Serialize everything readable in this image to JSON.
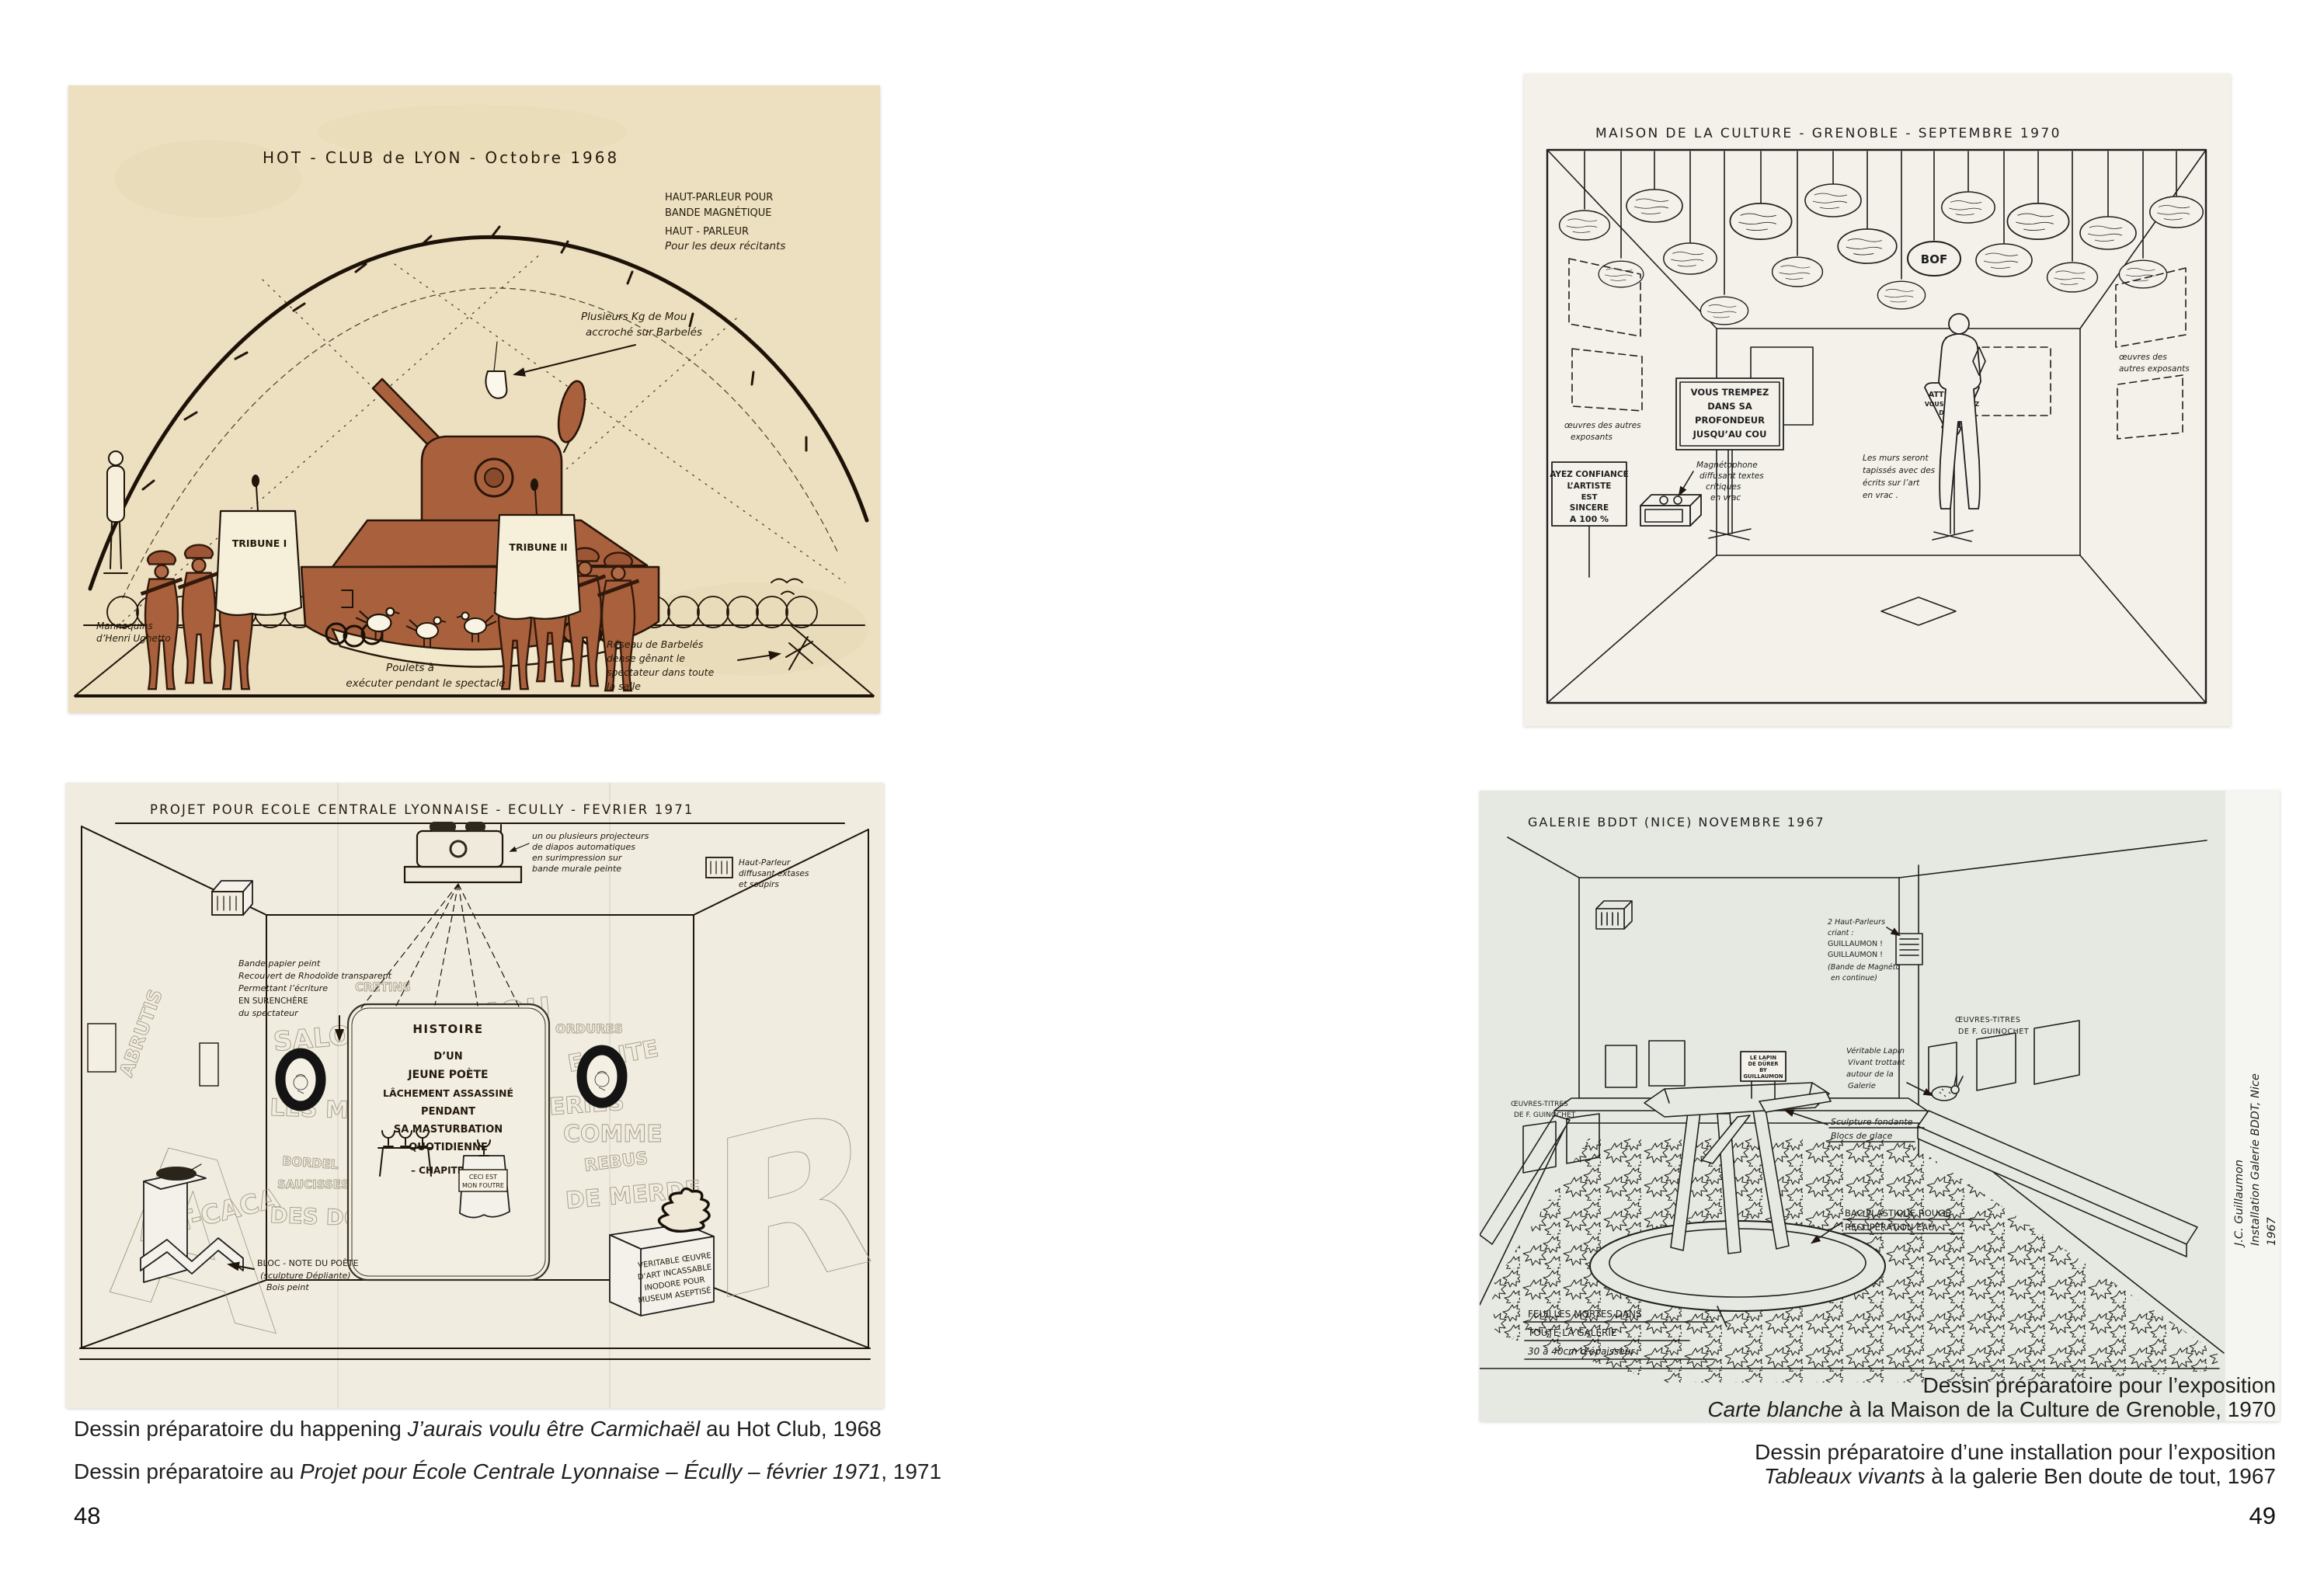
{
  "spread": {
    "left_page_number": "48",
    "right_page_number": "49"
  },
  "colors": {
    "page_bg": "#ffffff",
    "caption_text": "#1f1f1f",
    "paper_hotclub": "#ece0c0",
    "paper_ecole": "#f0ecdf",
    "paper_maison": "#f3f1e9",
    "paper_bddt": "#e6e8e2",
    "tank_brown": "#a8613c",
    "pencil_gray": "#a39a86",
    "ink": "#20150a"
  },
  "captions_left": [
    {
      "pre": "Dessin préparatoire du happening ",
      "italic": "J’aurais voulu être Carmichaël",
      "post": " au Hot Club, 1968"
    },
    {
      "pre": "Dessin préparatoire au ",
      "italic": "Projet pour École Centrale Lyonnaise – Écully – février 1971",
      "post": ", 1971"
    }
  ],
  "captions_right": [
    {
      "line1": "Dessin préparatoire pour l’exposition",
      "italic": "Carte blanche",
      "post": " à la Maison de la Culture de Grenoble, 1970"
    },
    {
      "line1": "Dessin préparatoire d’une installation pour l’exposition",
      "italic": "Tableaux vivants",
      "post": " à la galerie Ben doute de tout, 1967"
    }
  ],
  "hotclub": {
    "title": "HOT - CLUB  de  LYON  -  Octobre  1968",
    "speaker_note": [
      "HAUT-PARLEUR POUR",
      "BANDE MAGNÉTIQUE",
      "HAUT - PARLEUR",
      "Pour les deux récitants"
    ],
    "mou_note": [
      "Plusieurs Kg de Mou",
      "accroché sur Barbelés"
    ],
    "tribune1": "TRIBUNE I",
    "tribune2": "TRIBUNE II",
    "mannequins_note": [
      "Mannequins",
      "d’Henri Ughetto"
    ],
    "poulets_note": [
      "Poulets à",
      "exécuter pendant le spectacle"
    ],
    "reseau_note": [
      "Réseau de Barbelés",
      "dense gênant le",
      "spectateur dans toute",
      "la salle"
    ]
  },
  "ecole": {
    "title": "PROJET  POUR  ECOLE  CENTRALE  LYONNAISE - ECULLY -  FEVRIER  1971",
    "projector_note": [
      "un ou plusieurs projecteurs",
      "de diapos automatiques",
      "en surimpression sur",
      "bande murale peinte"
    ],
    "speaker_note": [
      "Haut-Parleur",
      "diffusant extases",
      "et soupirs"
    ],
    "bande_note": [
      "Bande papier peint",
      "Recouvert de Rhodoïde transparent",
      "Permettant l’écriture",
      "EN SURENCHÈRE",
      "du spectateur"
    ],
    "panel_lines": [
      "HISTOIRE",
      "D’UN",
      "JEUNE  POÈTE",
      "LÂCHEMENT  ASSASSINÉ",
      "PENDANT",
      "SA MASTURBATION",
      "QUOTIDIENNE",
      "– CHAPITRE I –"
    ],
    "graffiti": [
      "SALOPERIE",
      "LES MURS",
      "ART-CACA",
      "ABRUTIS",
      "BANDE",
      "MOU",
      "ORDURES",
      "ECRITE",
      "CRETINS",
      "BORDEL",
      "SAUCISSES",
      "DES DOIGTS",
      "COMME",
      "REBUS",
      "GALERIES",
      "DE MERDE"
    ],
    "wall_letters": [
      "A",
      "O",
      "O",
      "R"
    ],
    "ceci_note": [
      "CECI EST",
      "MON FOUTRE"
    ],
    "bloc_note": [
      "BLOC - NOTE DU POÈTE",
      "(sculpture Dépliante)",
      "Bois peint"
    ],
    "oeuvre_note": [
      "VERITABLE ŒUVRE",
      "D’ART INCASSABLE",
      "INODORE POUR",
      "MUSEUM ASEPTISÉ"
    ]
  },
  "maison": {
    "title": "MAISON  DE  LA  CULTURE  - GRENOBLE -  SEPTEMBRE  1970",
    "bof": "BOF",
    "trempez": [
      "VOUS TREMPEZ",
      "DANS SA",
      "PROFONDEUR",
      "JUSQU’AU COU"
    ],
    "confiance": [
      "AYEZ CONFIANCE",
      "L’ARTISTE",
      "EST",
      "SINCERE",
      "A 100 %"
    ],
    "attention": [
      "ATTENTION",
      "VOUS MARCHEZ",
      "DANS L’",
      "ART"
    ],
    "magneto_note": [
      "Magnétophone",
      "diffusant textes",
      "critiques",
      "en vrac"
    ],
    "murs_note": [
      "Les murs seront",
      "tapissés avec des",
      "écrits sur l’art",
      "en vrac ."
    ],
    "oeuvres_left": [
      "œuvres des autres",
      "exposants"
    ],
    "oeuvres_right": [
      "œuvres des",
      "autres exposants"
    ]
  },
  "bddt": {
    "title": "GALERIE  BDDT  (NICE)  NOVEMBRE 1967",
    "hp_note": [
      "2 Haut-Parleurs",
      "criant :",
      "GUILLAUMON !",
      "GUILLAUMON !",
      "(Bande de Magnéto",
      "en continue)"
    ],
    "oeuvres_left": [
      "ŒUVRES-TITRES",
      "DE F. GUINOCHET"
    ],
    "oeuvres_right": [
      "ŒUVRES-TITRES",
      "DE F. GUINOCHET"
    ],
    "lapin_sign": [
      "LE LAPIN",
      "DE DÜRER",
      "BY",
      "GUILLAUMON"
    ],
    "lapin_note": [
      "Véritable Lapin",
      "Vivant trottant",
      "autour de la",
      "Galerie"
    ],
    "sculpture_note": [
      "Sculpture fondante",
      "Blocs de glace"
    ],
    "bac_note": [
      "BAC PLASTIQUE ROUGE",
      "RECUPERATION EAU"
    ],
    "feuilles_note": [
      "FEUILLES MORTES DANS",
      "TOUTE LA GALERIE",
      "30 à 40cm d’épaisseur"
    ],
    "side_note": [
      "J.C. Guillaumon",
      "Installation Galerie BDDT, Nice",
      "1967"
    ]
  }
}
